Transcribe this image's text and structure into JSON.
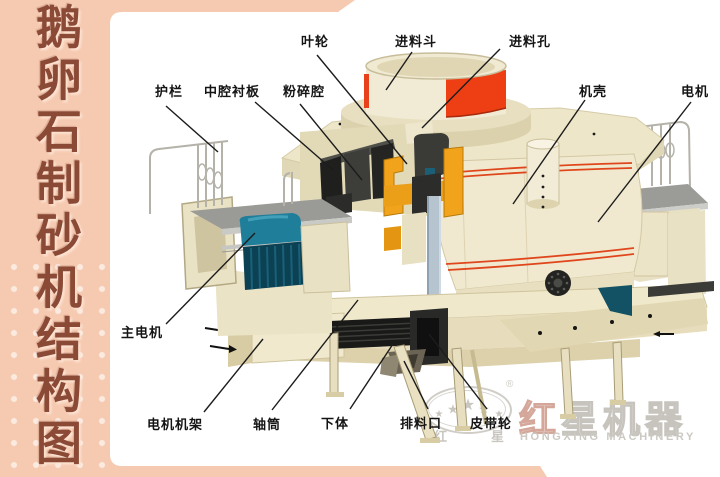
{
  "sidebar": {
    "title": "鹅卵石制砂机结构图"
  },
  "labels": [
    {
      "id": "yelun",
      "text": "叶轮"
    },
    {
      "id": "jinliaodou",
      "text": "进料斗"
    },
    {
      "id": "jinliaokong",
      "text": "进料孔"
    },
    {
      "id": "hulan",
      "text": "护栏"
    },
    {
      "id": "zhongqiang",
      "text": "中腔衬板"
    },
    {
      "id": "fensuiqiang",
      "text": "粉碎腔"
    },
    {
      "id": "jike",
      "text": "机壳"
    },
    {
      "id": "dianji",
      "text": "电机"
    },
    {
      "id": "zhudianji",
      "text": "主电机"
    },
    {
      "id": "dianjijijia",
      "text": "电机机架"
    },
    {
      "id": "zhoutong",
      "text": "轴筒"
    },
    {
      "id": "xiati",
      "text": "下体"
    },
    {
      "id": "pailiaokou",
      "text": "排料口"
    },
    {
      "id": "pidailun",
      "text": "皮带轮"
    }
  ],
  "watermark": {
    "reg": "®",
    "star": "★",
    "hanzi_left": "红",
    "hanzi_right": "星",
    "brand_first": "红",
    "brand_rest": "星机器",
    "brand_en": "HONGXING MACHINERY"
  },
  "colors": {
    "sidebar_pink": "#f6cab1",
    "title_brown": "#8a4a36",
    "hopper_red": "#ee3f14",
    "stripe_red": "#e0461c",
    "motor_teal": "#1f7e9a",
    "motor_teal_dark": "#0d4456",
    "impeller_orange": "#f2a31c",
    "body_cream": "#f0e9cf",
    "shaft_bluegray": "#b6c4d0"
  }
}
